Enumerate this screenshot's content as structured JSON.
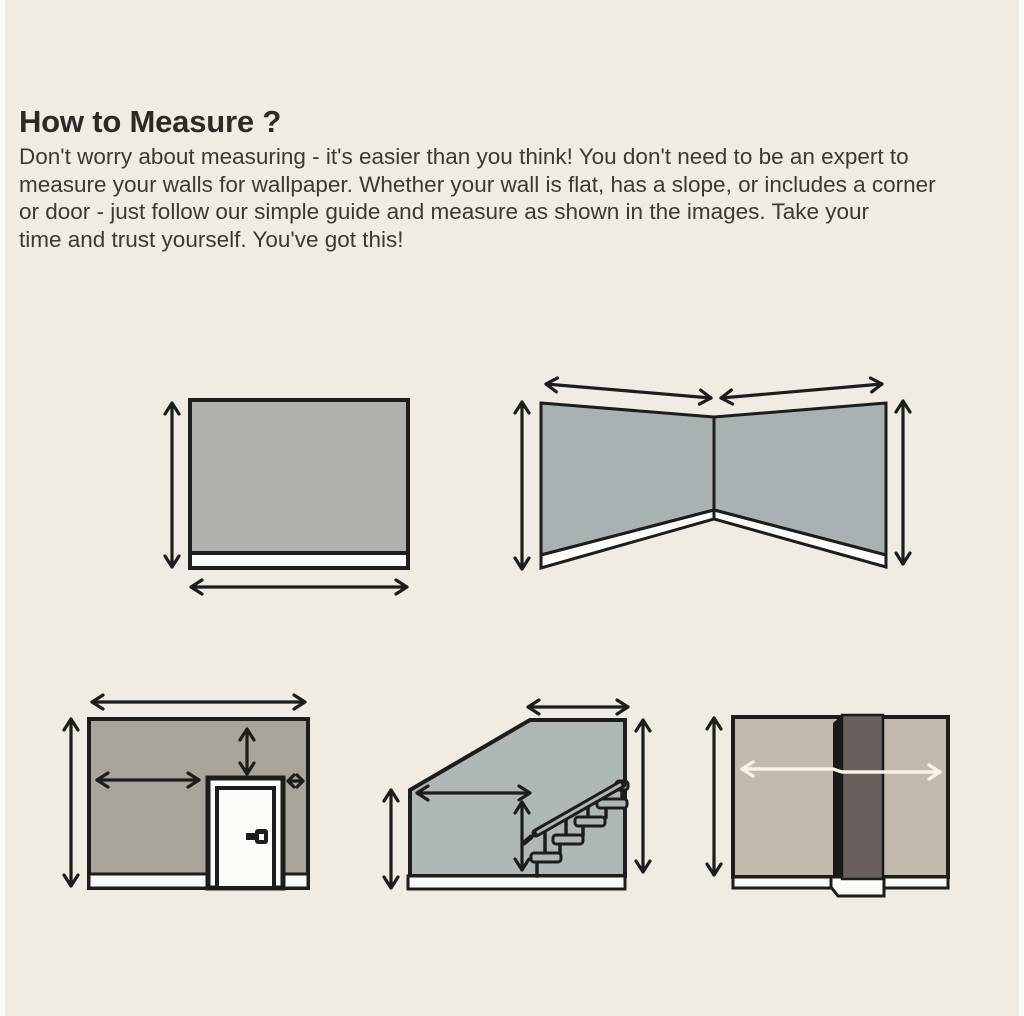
{
  "page": {
    "title": "How to Measure ?",
    "intro_lines": [
      "Don't worry about measuring - it's easier than you think! You don't need to be an expert to",
      "measure your walls for wallpaper. Whether your wall is flat, has a slope, or includes a corner",
      "or door - just follow our simple guide and measure as shown in the images. Take your",
      "time and trust yourself. You've got this!"
    ]
  },
  "diagrams": [
    {
      "name": "flat-wall"
    },
    {
      "name": "corner-wall"
    },
    {
      "name": "wall-with-door"
    },
    {
      "name": "sloped-wall-with-staircase"
    },
    {
      "name": "wall-with-pillar"
    }
  ],
  "colors": {
    "page_background": "#f0ebe3",
    "edge_highlight": "#fbfaf8",
    "title_color": "#2b2a26",
    "body_text_color": "#3a3934",
    "outline": "#1d1d1b",
    "wall_gray": "#b2b0ac",
    "wall_blue_gray": "#a9b2b2",
    "wall_blue_gray_light": "#b0b8b7",
    "wall_taupe": "#a9a49c",
    "wall_beige": "#c2baad",
    "pillar_brown": "#695f5c",
    "pillar_shadow": "#1a1a18",
    "baseboard_white": "#fcfbf7",
    "arrow_dark": "#1d1d1b",
    "arrow_light": "#f7f3ea"
  }
}
